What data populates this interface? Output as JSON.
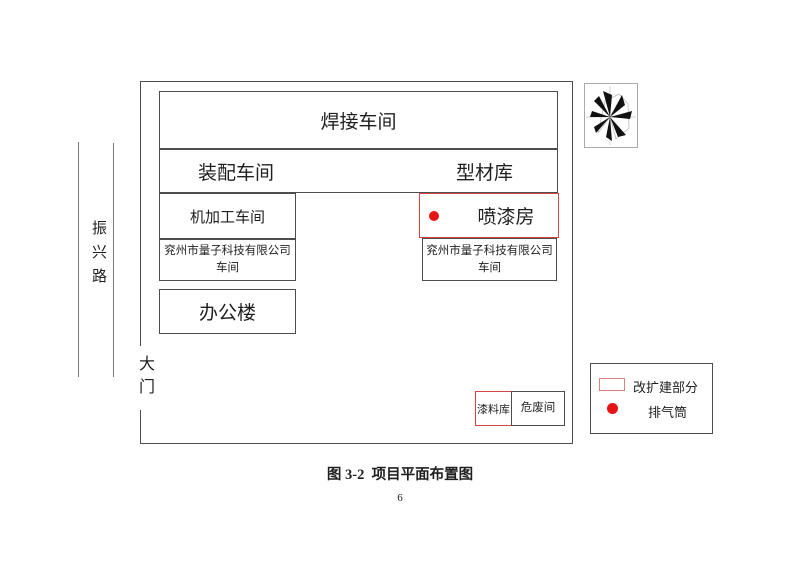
{
  "figure": {
    "caption": "图 3-2  项目平面布置图",
    "page_number": "6"
  },
  "road": {
    "name": "振兴路"
  },
  "gate": {
    "label": "大门"
  },
  "buildings": {
    "welding_workshop": "焊接车间",
    "assembly_workshop": "装配车间",
    "profile_warehouse": "型材库",
    "machining_workshop": "机加工车间",
    "company_workshop_left": {
      "line1": "兖州市量子科技有限公司",
      "line2": "车间"
    },
    "office_building": "办公楼",
    "paint_spray_room": "喷漆房",
    "company_workshop_right": {
      "line1": "兖州市量子科技有限公司",
      "line2": "车间"
    },
    "paint_material_store": "漆料库",
    "hazardous_waste_room": "危废间"
  },
  "legend": {
    "items": [
      {
        "symbol": "red-outline-rect",
        "label": "改扩建部分"
      },
      {
        "symbol": "red-filled-dot",
        "label": "排气筒"
      }
    ]
  },
  "compass": {
    "type": "wind-rose"
  },
  "colors": {
    "red_border": "#d94444",
    "red_dot": "#e61414",
    "black_line": "#4d4d4d",
    "road_line": "#777777"
  }
}
